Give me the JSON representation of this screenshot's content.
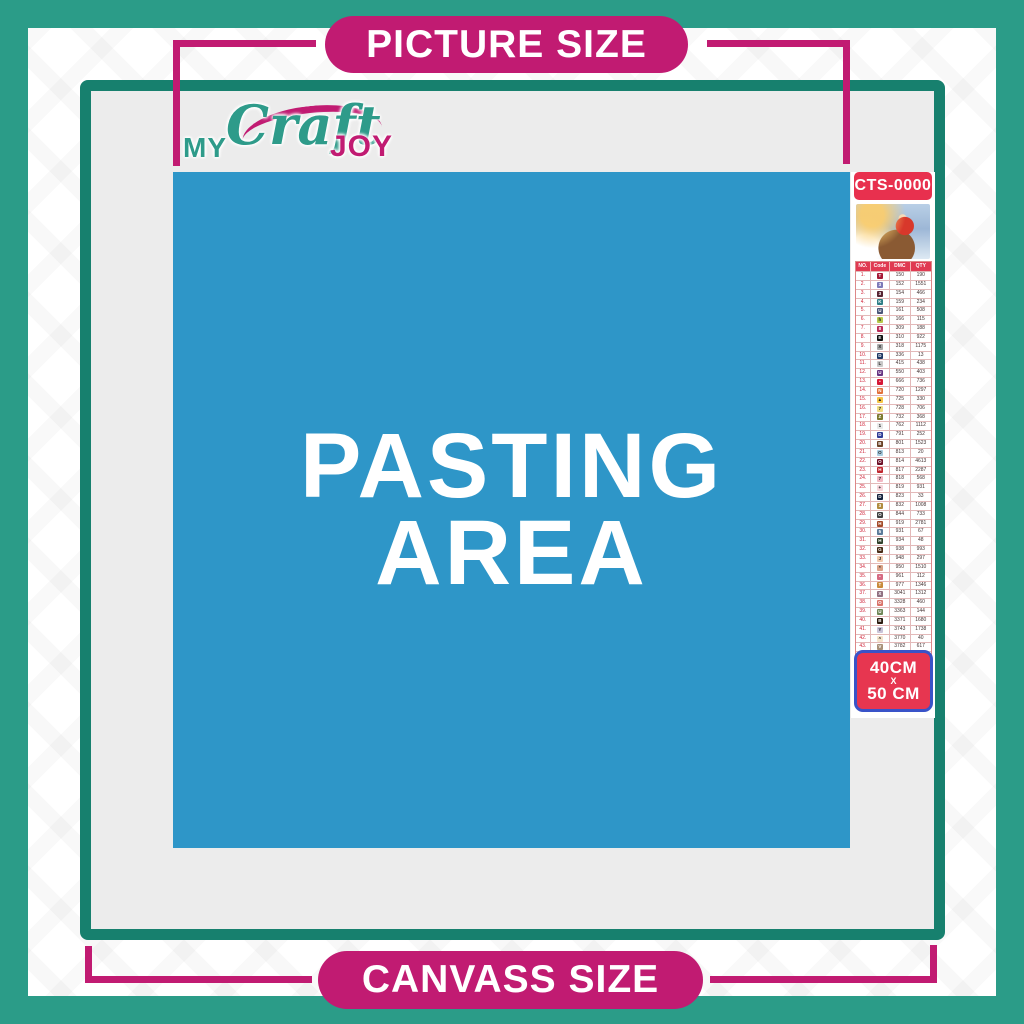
{
  "banners": {
    "top_label": "PICTURE SIZE",
    "bottom_label": "CANVASS SIZE"
  },
  "logo": {
    "my": "MY",
    "craft": "Craft",
    "joy": "JOY"
  },
  "pasting_area": {
    "line1": "PASTING",
    "line2": "AREA"
  },
  "sidebar": {
    "sku": "CTS-0000",
    "thumbnail": "santa-sleigh-christmas-scene",
    "table": {
      "headers": [
        "NO.",
        "Code",
        "DMC",
        "QTY"
      ],
      "rows": [
        {
          "no": "1.",
          "sym": "T",
          "bg": "#a61836",
          "fg": "#fff",
          "dmc": "150",
          "qty": "190"
        },
        {
          "no": "2.",
          "sym": "3",
          "bg": "#7d7ab8",
          "fg": "#fff",
          "dmc": "152",
          "qty": "1551"
        },
        {
          "no": "3.",
          "sym": "3",
          "bg": "#572433",
          "fg": "#fff",
          "dmc": "154",
          "qty": "466"
        },
        {
          "no": "4.",
          "sym": "K",
          "bg": "#2e7d86",
          "fg": "#fff",
          "dmc": "159",
          "qty": "234"
        },
        {
          "no": "5.",
          "sym": "U",
          "bg": "#4a5578",
          "fg": "#fff",
          "dmc": "161",
          "qty": "508"
        },
        {
          "no": "6.",
          "sym": "h",
          "bg": "#b6c94a",
          "fg": "#222",
          "dmc": "166",
          "qty": "115"
        },
        {
          "no": "7.",
          "sym": "8",
          "bg": "#ba2c58",
          "fg": "#fff",
          "dmc": "309",
          "qty": "188"
        },
        {
          "no": "8.",
          "sym": "E",
          "bg": "#111111",
          "fg": "#fff",
          "dmc": "310",
          "qty": "922"
        },
        {
          "no": "9.",
          "sym": "X",
          "bg": "#aaaaaa",
          "fg": "#222",
          "dmc": "318",
          "qty": "1175"
        },
        {
          "no": "10.",
          "sym": "D",
          "bg": "#1f3864",
          "fg": "#fff",
          "dmc": "336",
          "qty": "13"
        },
        {
          "no": "11.",
          "sym": "L",
          "bg": "#c8c8c8",
          "fg": "#222",
          "dmc": "415",
          "qty": "438"
        },
        {
          "no": "12.",
          "sym": "U",
          "bg": "#663382",
          "fg": "#fff",
          "dmc": "550",
          "qty": "403"
        },
        {
          "no": "13.",
          "sym": "•",
          "bg": "#d61836",
          "fg": "#fff",
          "dmc": "666",
          "qty": "736"
        },
        {
          "no": "14.",
          "sym": "N",
          "bg": "#e2703a",
          "fg": "#fff",
          "dmc": "720",
          "qty": "1297"
        },
        {
          "no": "15.",
          "sym": "▲",
          "bg": "#f6c445",
          "fg": "#222",
          "dmc": "725",
          "qty": "330"
        },
        {
          "no": "16.",
          "sym": "7",
          "bg": "#f0dc82",
          "fg": "#222",
          "dmc": "728",
          "qty": "706"
        },
        {
          "no": "17.",
          "sym": "Z",
          "bg": "#7d7a2f",
          "fg": "#fff",
          "dmc": "732",
          "qty": "368"
        },
        {
          "no": "18.",
          "sym": "1",
          "bg": "#e8e8e8",
          "fg": "#222",
          "dmc": "762",
          "qty": "1112"
        },
        {
          "no": "19.",
          "sym": "D",
          "bg": "#2f3c96",
          "fg": "#fff",
          "dmc": "791",
          "qty": "252"
        },
        {
          "no": "20.",
          "sym": "B",
          "bg": "#6b4226",
          "fg": "#fff",
          "dmc": "801",
          "qty": "1523"
        },
        {
          "no": "21.",
          "sym": "O",
          "bg": "#a8cce0",
          "fg": "#222",
          "dmc": "813",
          "qty": "20"
        },
        {
          "no": "22.",
          "sym": "O",
          "bg": "#6e0f26",
          "fg": "#fff",
          "dmc": "814",
          "qty": "4613"
        },
        {
          "no": "23.",
          "sym": "H",
          "bg": "#c0272f",
          "fg": "#fff",
          "dmc": "817",
          "qty": "2287"
        },
        {
          "no": "24.",
          "sym": "7",
          "bg": "#f2b8c4",
          "fg": "#222",
          "dmc": "818",
          "qty": "568"
        },
        {
          "no": "25.",
          "sym": "+",
          "bg": "#f6d4da",
          "fg": "#222",
          "dmc": "819",
          "qty": "931"
        },
        {
          "no": "26.",
          "sym": "D",
          "bg": "#14213d",
          "fg": "#fff",
          "dmc": "823",
          "qty": "33"
        },
        {
          "no": "27.",
          "sym": "3",
          "bg": "#b08c3e",
          "fg": "#fff",
          "dmc": "832",
          "qty": "1008"
        },
        {
          "no": "28.",
          "sym": "O",
          "bg": "#3f3f3f",
          "fg": "#fff",
          "dmc": "844",
          "qty": "733"
        },
        {
          "no": "29.",
          "sym": "H",
          "bg": "#a34a28",
          "fg": "#fff",
          "dmc": "919",
          "qty": "2781"
        },
        {
          "no": "30.",
          "sym": "5",
          "bg": "#5b7a99",
          "fg": "#fff",
          "dmc": "931",
          "qty": "67"
        },
        {
          "no": "31.",
          "sym": "H",
          "bg": "#30402a",
          "fg": "#fff",
          "dmc": "934",
          "qty": "48"
        },
        {
          "no": "32.",
          "sym": "G",
          "bg": "#4a2c17",
          "fg": "#fff",
          "dmc": "938",
          "qty": "993"
        },
        {
          "no": "33.",
          "sym": "J",
          "bg": "#f2c9ad",
          "fg": "#222",
          "dmc": "948",
          "qty": "297"
        },
        {
          "no": "34.",
          "sym": "*",
          "bg": "#d9a186",
          "fg": "#222",
          "dmc": "950",
          "qty": "1510"
        },
        {
          "no": "35.",
          "sym": "•",
          "bg": "#d66a82",
          "fg": "#fff",
          "dmc": "961",
          "qty": "112"
        },
        {
          "no": "36.",
          "sym": "T",
          "bg": "#c98b3c",
          "fg": "#fff",
          "dmc": "977",
          "qty": "1346"
        },
        {
          "no": "37.",
          "sym": "X",
          "bg": "#8f6f80",
          "fg": "#fff",
          "dmc": "3041",
          "qty": "1312"
        },
        {
          "no": "38.",
          "sym": "O",
          "bg": "#d9746a",
          "fg": "#fff",
          "dmc": "3328",
          "qty": "460"
        },
        {
          "no": "39.",
          "sym": "U",
          "bg": "#6f8657",
          "fg": "#fff",
          "dmc": "3363",
          "qty": "144"
        },
        {
          "no": "40.",
          "sym": "B",
          "bg": "#2b1b10",
          "fg": "#fff",
          "dmc": "3371",
          "qty": "1680"
        },
        {
          "no": "41.",
          "sym": "Y",
          "bg": "#c9c3d9",
          "fg": "#222",
          "dmc": "3743",
          "qty": "1738"
        },
        {
          "no": "42.",
          "sym": "^",
          "bg": "#f4e3cb",
          "fg": "#222",
          "dmc": "3770",
          "qty": "40"
        },
        {
          "no": "43.",
          "sym": "V",
          "bg": "#a89078",
          "fg": "#fff",
          "dmc": "3782",
          "qty": "617"
        },
        {
          "no": "44.",
          "sym": "2",
          "bg": "#aeb439",
          "fg": "#222",
          "dmc": "3819",
          "qty": "119"
        },
        {
          "no": "45.",
          "sym": "✓",
          "bg": "#f2e3a8",
          "fg": "#222",
          "dmc": "3823",
          "qty": "107"
        },
        {
          "no": "46.",
          "sym": "C",
          "bg": "#e09b42",
          "fg": "#fff",
          "dmc": "3853",
          "qty": "1332"
        },
        {
          "no": "47.",
          "sym": "X",
          "bg": "#7a4a42",
          "fg": "#fff",
          "dmc": "3858",
          "qty": "2311"
        },
        {
          "no": "48.",
          "sym": "A",
          "bg": "#8c6f5a",
          "fg": "#fff",
          "dmc": "3863",
          "qty": "1820"
        }
      ]
    },
    "size_label": {
      "line1": "40CM",
      "line2": "X",
      "line3": "50 CM"
    }
  },
  "colors": {
    "outer_teal": "#2B9C88",
    "frame_teal": "#17806E",
    "magenta": "#C11B72",
    "canvas_gray": "#ECECEC",
    "pasting_blue": "#2E96C8",
    "badge_red": "#E8304E",
    "table_header_red": "#E03A52",
    "size_box_red": "#E73650",
    "size_box_border_blue": "#3953C8"
  }
}
